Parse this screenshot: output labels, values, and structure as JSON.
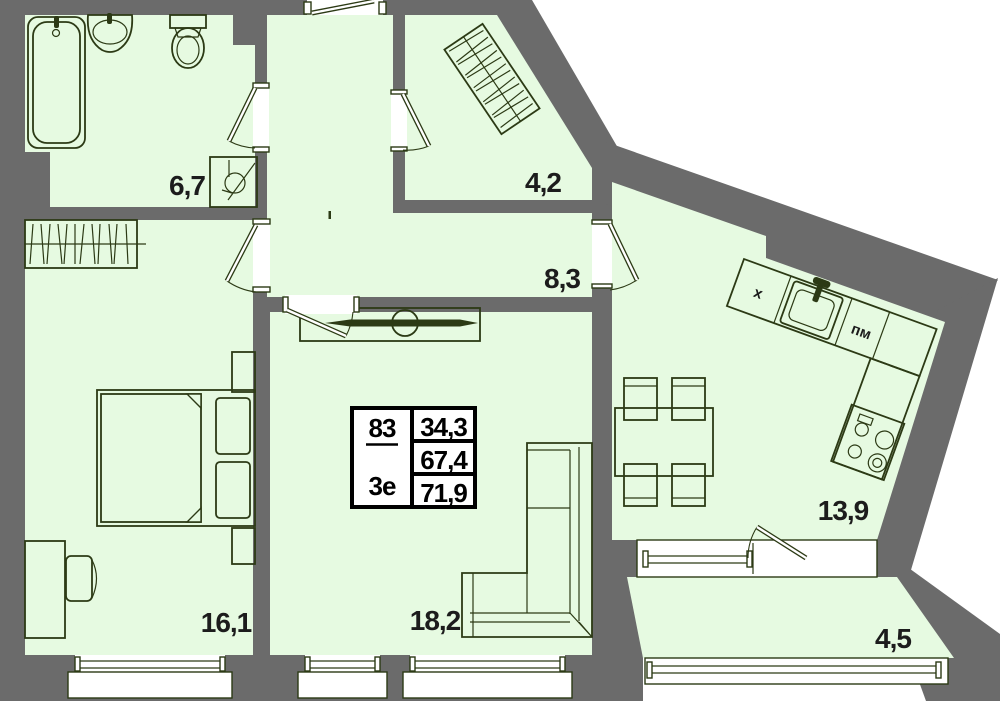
{
  "plan": {
    "unit": {
      "number": "83",
      "layout_type": "3е",
      "living_area": "34,3",
      "apartment_area": "67,4",
      "total_area": "71,9"
    },
    "rooms": {
      "bathroom": "6,7",
      "dressing": "4,2",
      "hall": "8,3",
      "bedroom": "16,1",
      "living_room": "18,2",
      "kitchen_living": "13,9",
      "balcony": "4,5"
    },
    "kitchen": {
      "fridge_label": "х",
      "dishwasher_label": "пм"
    },
    "colors": {
      "floor": "#e6fae1",
      "wall": "#6b6b6b",
      "line": "#2c3a15",
      "text": "#1c1c1c"
    }
  }
}
